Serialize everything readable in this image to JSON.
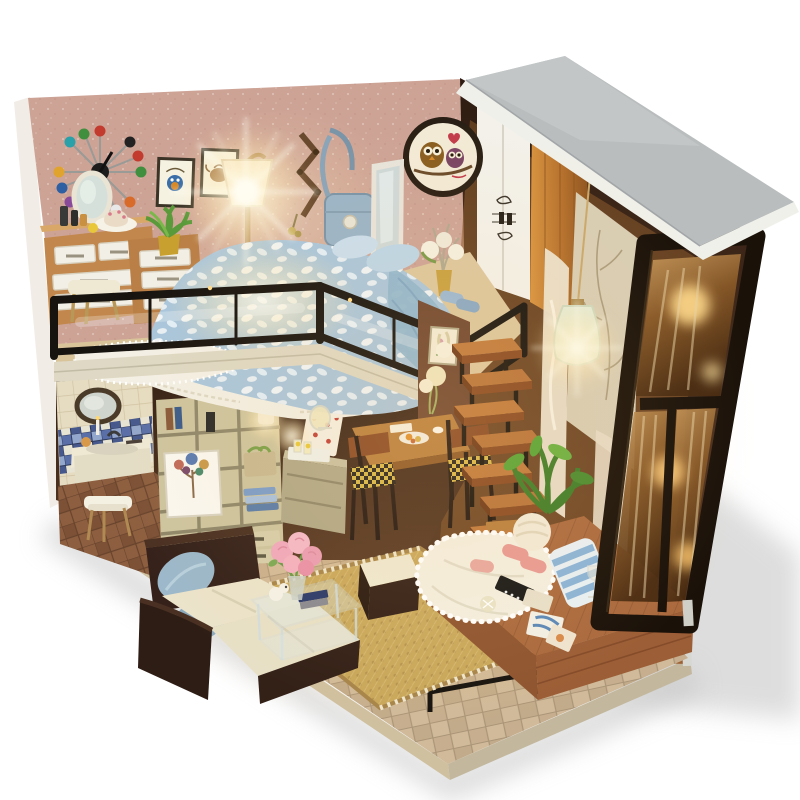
{
  "meta": {
    "title": "DIY miniature dollhouse — loft apartment kit",
    "type": "product photograph",
    "description": "Miniature DIY wooden dollhouse of a modern loft apartment, photographed on a white background: loft bed with blue floral blanket behind a black glass railing, open wooden staircase, lit floor lamp and pendant lamp, living room with dark sofa and rose bouquet, bathroom nook, shelving, dining set, wardrobe, and a black-framed glass window wall under a gray slanted roof panel.",
    "background": "#ffffff"
  },
  "palette": {
    "wall_pink": "#cda396",
    "wall_pink_light": "#e6c6b4",
    "roof_gray": "#b9bdbe",
    "roof_rim": "#f0f0ea",
    "frame_black": "#1a1109",
    "railing_black": "#17130f",
    "wood_furniture": "#c1874c",
    "wood_stair": "#a35a2a",
    "wood_platform": "#ab6a3e",
    "base_wood": "#9c6236",
    "floor_tile": "#d0ba9a",
    "bath_floor": "#8d5f40",
    "tile_cream": "#e6dcc2",
    "mosaic_blue": "#5a6fa8",
    "shelving_olive": "#cdc49e",
    "sofa_dark": "#35211a",
    "cushion_cream": "#ebe3ca",
    "pillow_blue": "#9cb8ca",
    "blanket_blue": "#a9c6dc",
    "lace_white": "#f2eee2",
    "rug_tan": "#c9a85c",
    "glass_amber": "#8a5a28",
    "glow_warm": "#ffe9b8",
    "curtain_beige": "#d8cdb4",
    "accent_rose": "#f0a8bc"
  },
  "objects": {
    "ball_clock": {
      "label": "mid-century ball wall clock",
      "ball_colors": [
        "#c23b2e",
        "#2e5fa3",
        "#3f8f3f",
        "#e0a32e",
        "#222222",
        "#8a4a9a",
        "#d86a2a",
        "#2aa0a8",
        "#c23b2e",
        "#2e5fa3",
        "#e8e8e8",
        "#3f8f3f"
      ]
    },
    "picture_frames": {
      "label": "two framed art prints (owl, teapot)"
    },
    "owl_wall_clock": {
      "label": "round owl-couple wall clock"
    },
    "floor_lamp": {
      "label": "lit floor lamp with cone shade"
    },
    "pendant_lamp": {
      "label": "lit glass pendant lamp"
    },
    "dresser": {
      "label": "wooden dresser with white drawers, vanity mirror, cake and bottles"
    },
    "potted_plant": {
      "label": "green plant in gold pot"
    },
    "stool": {
      "label": "cream vanity stool"
    },
    "coat_rack": {
      "label": "wall coat rack with keys"
    },
    "shoulder_bag": {
      "label": "blue shoulder bag on hook"
    },
    "full_length_mirror": {
      "label": "white leaning full-length mirror"
    },
    "loft_bed": {
      "label": "loft bed with blue floral blanket, pillows and lace mattress skirt"
    },
    "glass_railing": {
      "label": "black-framed glass loft railing"
    },
    "white_rug": {
      "label": "white fringed rug on loft floor"
    },
    "slippers_blue": {
      "label": "blue slippers on loft"
    },
    "flower_vase": {
      "label": "gold vase with white flowers"
    },
    "wardrobe": {
      "label": "wardrobe with white sliding door and wooden door"
    },
    "curtains": {
      "label": "beige tree-print curtain and white lace curtains"
    },
    "staircase": {
      "label": "open wooden staircase with black supports"
    },
    "green_plant": {
      "label": "leafy green plant beside stairs"
    },
    "dining_set": {
      "label": "wooden dining table with breakfast plates and houndstooth chairs"
    },
    "drinks_cabinet": {
      "label": "side cabinet with lemonade pitcher tray"
    },
    "bathroom": {
      "label": "bathroom nook: round mirror, blue mosaic band, sink vanity, towel stool"
    },
    "shelving_unit": {
      "label": "olive shelving unit with books, towels, heart-tree print and lit lamp"
    },
    "polka_dot_board": {
      "label": "white board with red polka dots"
    },
    "sofa": {
      "label": "dark brown L-sofa with cream cushions and blue pillows"
    },
    "coffee_table": {
      "label": "clear acrylic coffee table with books and dog figurine"
    },
    "rose_bouquet": {
      "label": "pink rose bouquet in vase"
    },
    "ottoman": {
      "label": "dark ottoman with cream top"
    },
    "area_rug": {
      "label": "woven tan area rug"
    },
    "window_wall": {
      "label": "black-framed glass window wall, warm light glowing through"
    },
    "roof_panel": {
      "label": "gray slanted roof panel with white rim"
    },
    "wooden_base": {
      "label": "wooden display base with metal corner trim"
    },
    "daybed_platform": {
      "label": "raised wooden window platform with white pompom knit blanket, striped cushion, pink slippers, remote and postcards"
    }
  }
}
